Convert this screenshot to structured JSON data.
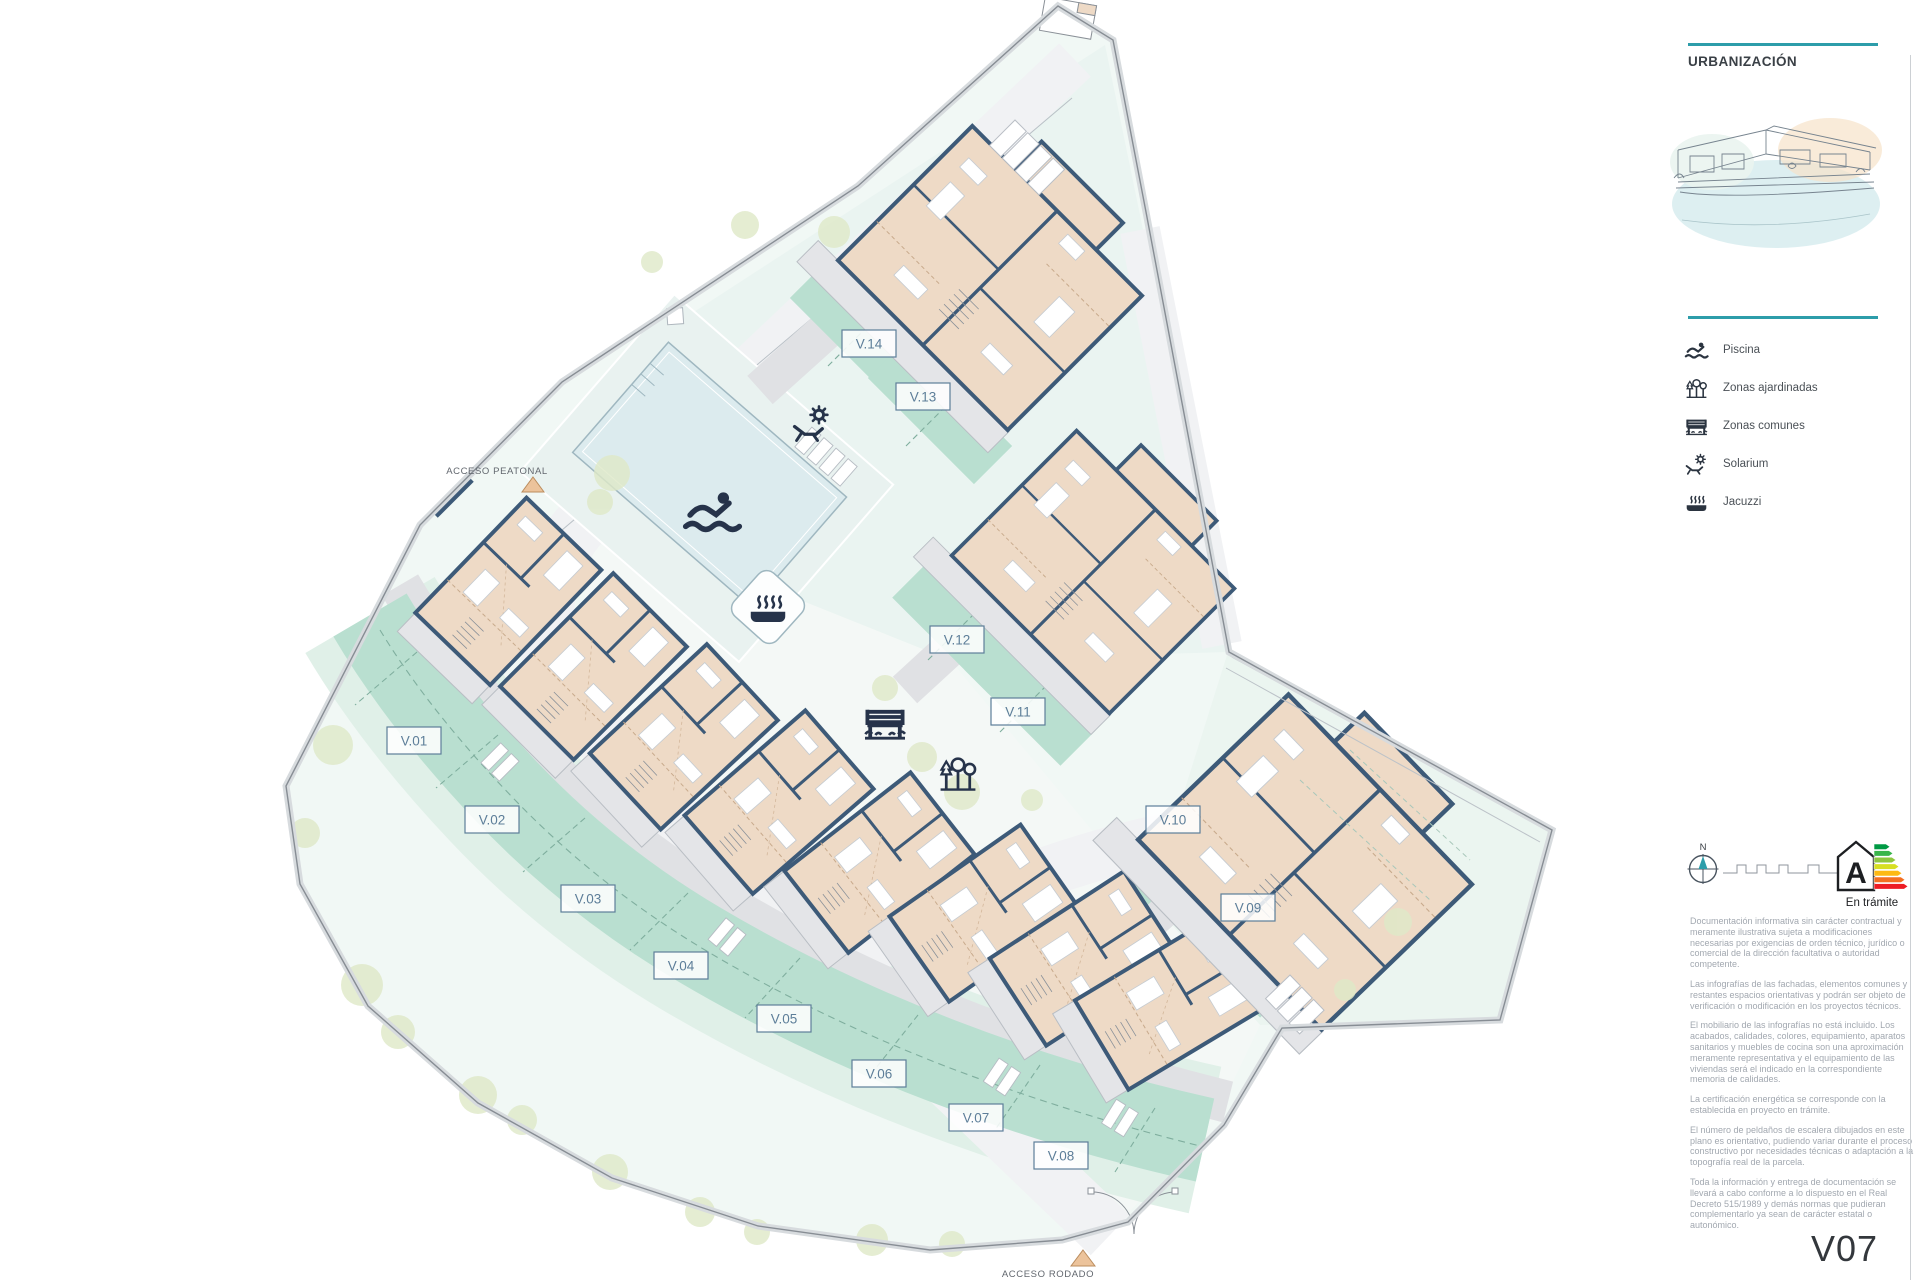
{
  "sidebar": {
    "title": "URBANIZACIÓN"
  },
  "legend": {
    "items": [
      {
        "icon": "swimmer-icon",
        "label": "Piscina"
      },
      {
        "icon": "trees-icon",
        "label": "Zonas ajardinadas"
      },
      {
        "icon": "bench-icon",
        "label": "Zonas comunes"
      },
      {
        "icon": "solarium-icon",
        "label": "Solarium"
      },
      {
        "icon": "jacuzzi-icon",
        "label": "Jacuzzi"
      }
    ]
  },
  "plan": {
    "villas": [
      {
        "label": "V.01"
      },
      {
        "label": "V.02"
      },
      {
        "label": "V.03"
      },
      {
        "label": "V.04"
      },
      {
        "label": "V.05"
      },
      {
        "label": "V.06"
      },
      {
        "label": "V.07"
      },
      {
        "label": "V.08"
      },
      {
        "label": "V.09"
      },
      {
        "label": "V.10"
      },
      {
        "label": "V.11"
      },
      {
        "label": "V.12"
      },
      {
        "label": "V.13"
      },
      {
        "label": "V.14"
      }
    ],
    "access_pedestrian": "ACCESO PEATONAL",
    "access_road": "ACCESO RODADO",
    "icons": {
      "pool": "swimmer-icon",
      "gardens": "trees-icon",
      "commons": "bench-icon",
      "solarium": "solarium-icon",
      "jacuzzi": "jacuzzi-icon"
    }
  },
  "compass": {
    "north_label": "N"
  },
  "energy": {
    "letter": "A",
    "status": "En trámite"
  },
  "notes": [
    "Documentación informativa sin carácter contractual y meramente ilustrativa sujeta a modificaciones necesarias por exigencias de orden técnico, jurídico o comercial de la dirección facultativa o autoridad competente.",
    "Las infografías de las fachadas, elementos comunes y restantes espacios orientativas y podrán ser objeto de verificación o modificación en los proyectos técnicos.",
    "El mobiliario de las infografías no está incluido. Los acabados, calidades, colores, equipamiento, aparatos sanitarios y muebles de cocina son una aproximación meramente representativa y el equipamiento de las viviendas será el indicado en la correspondiente memoria de calidades.",
    "La certificación energética se corresponde con la establecida en proyecto en trámite.",
    "El número de peldaños de escalera dibujados en este plano es orientativo, pudiendo variar durante el proceso constructivo por necesidades técnicas o adaptación a la topografía real de la parcela.",
    "Toda la información y entrega de documentación se llevará a cabo conforme a lo dispuesto en el Real Decreto 515/1989 y demás normas que pudieran complementarlo ya sean de carácter estatal o autonómico."
  ],
  "sheet_code": "V07",
  "colors": {
    "accent_teal": "#2d9daa",
    "wall": "#3d5a78",
    "building_fill": "#eedac6",
    "garden_mint": "#b9dfd0",
    "pool_blue": "#dcebee",
    "label_blue": "#5d7e99",
    "note_grey": "#a2a8b0"
  }
}
